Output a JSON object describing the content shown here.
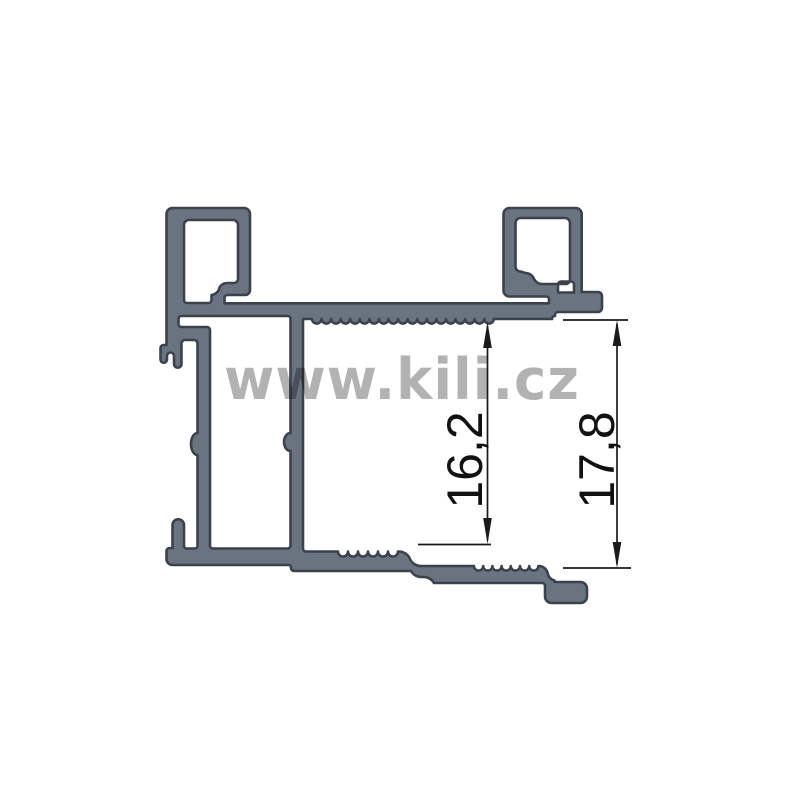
{
  "watermark": {
    "text": "www.kili.cz",
    "color": "#b1b1b1"
  },
  "dimensions": [
    {
      "id": "inner-channel-height",
      "label": "16,2"
    },
    {
      "id": "overall-height",
      "label": "17,8"
    }
  ],
  "colors": {
    "background": "#ffffff",
    "profile_fill": "#6a7380",
    "profile_outline": "#3c424c",
    "dimension_lines": "#1a1a1a",
    "watermark_gray": "#b1b1b1"
  }
}
